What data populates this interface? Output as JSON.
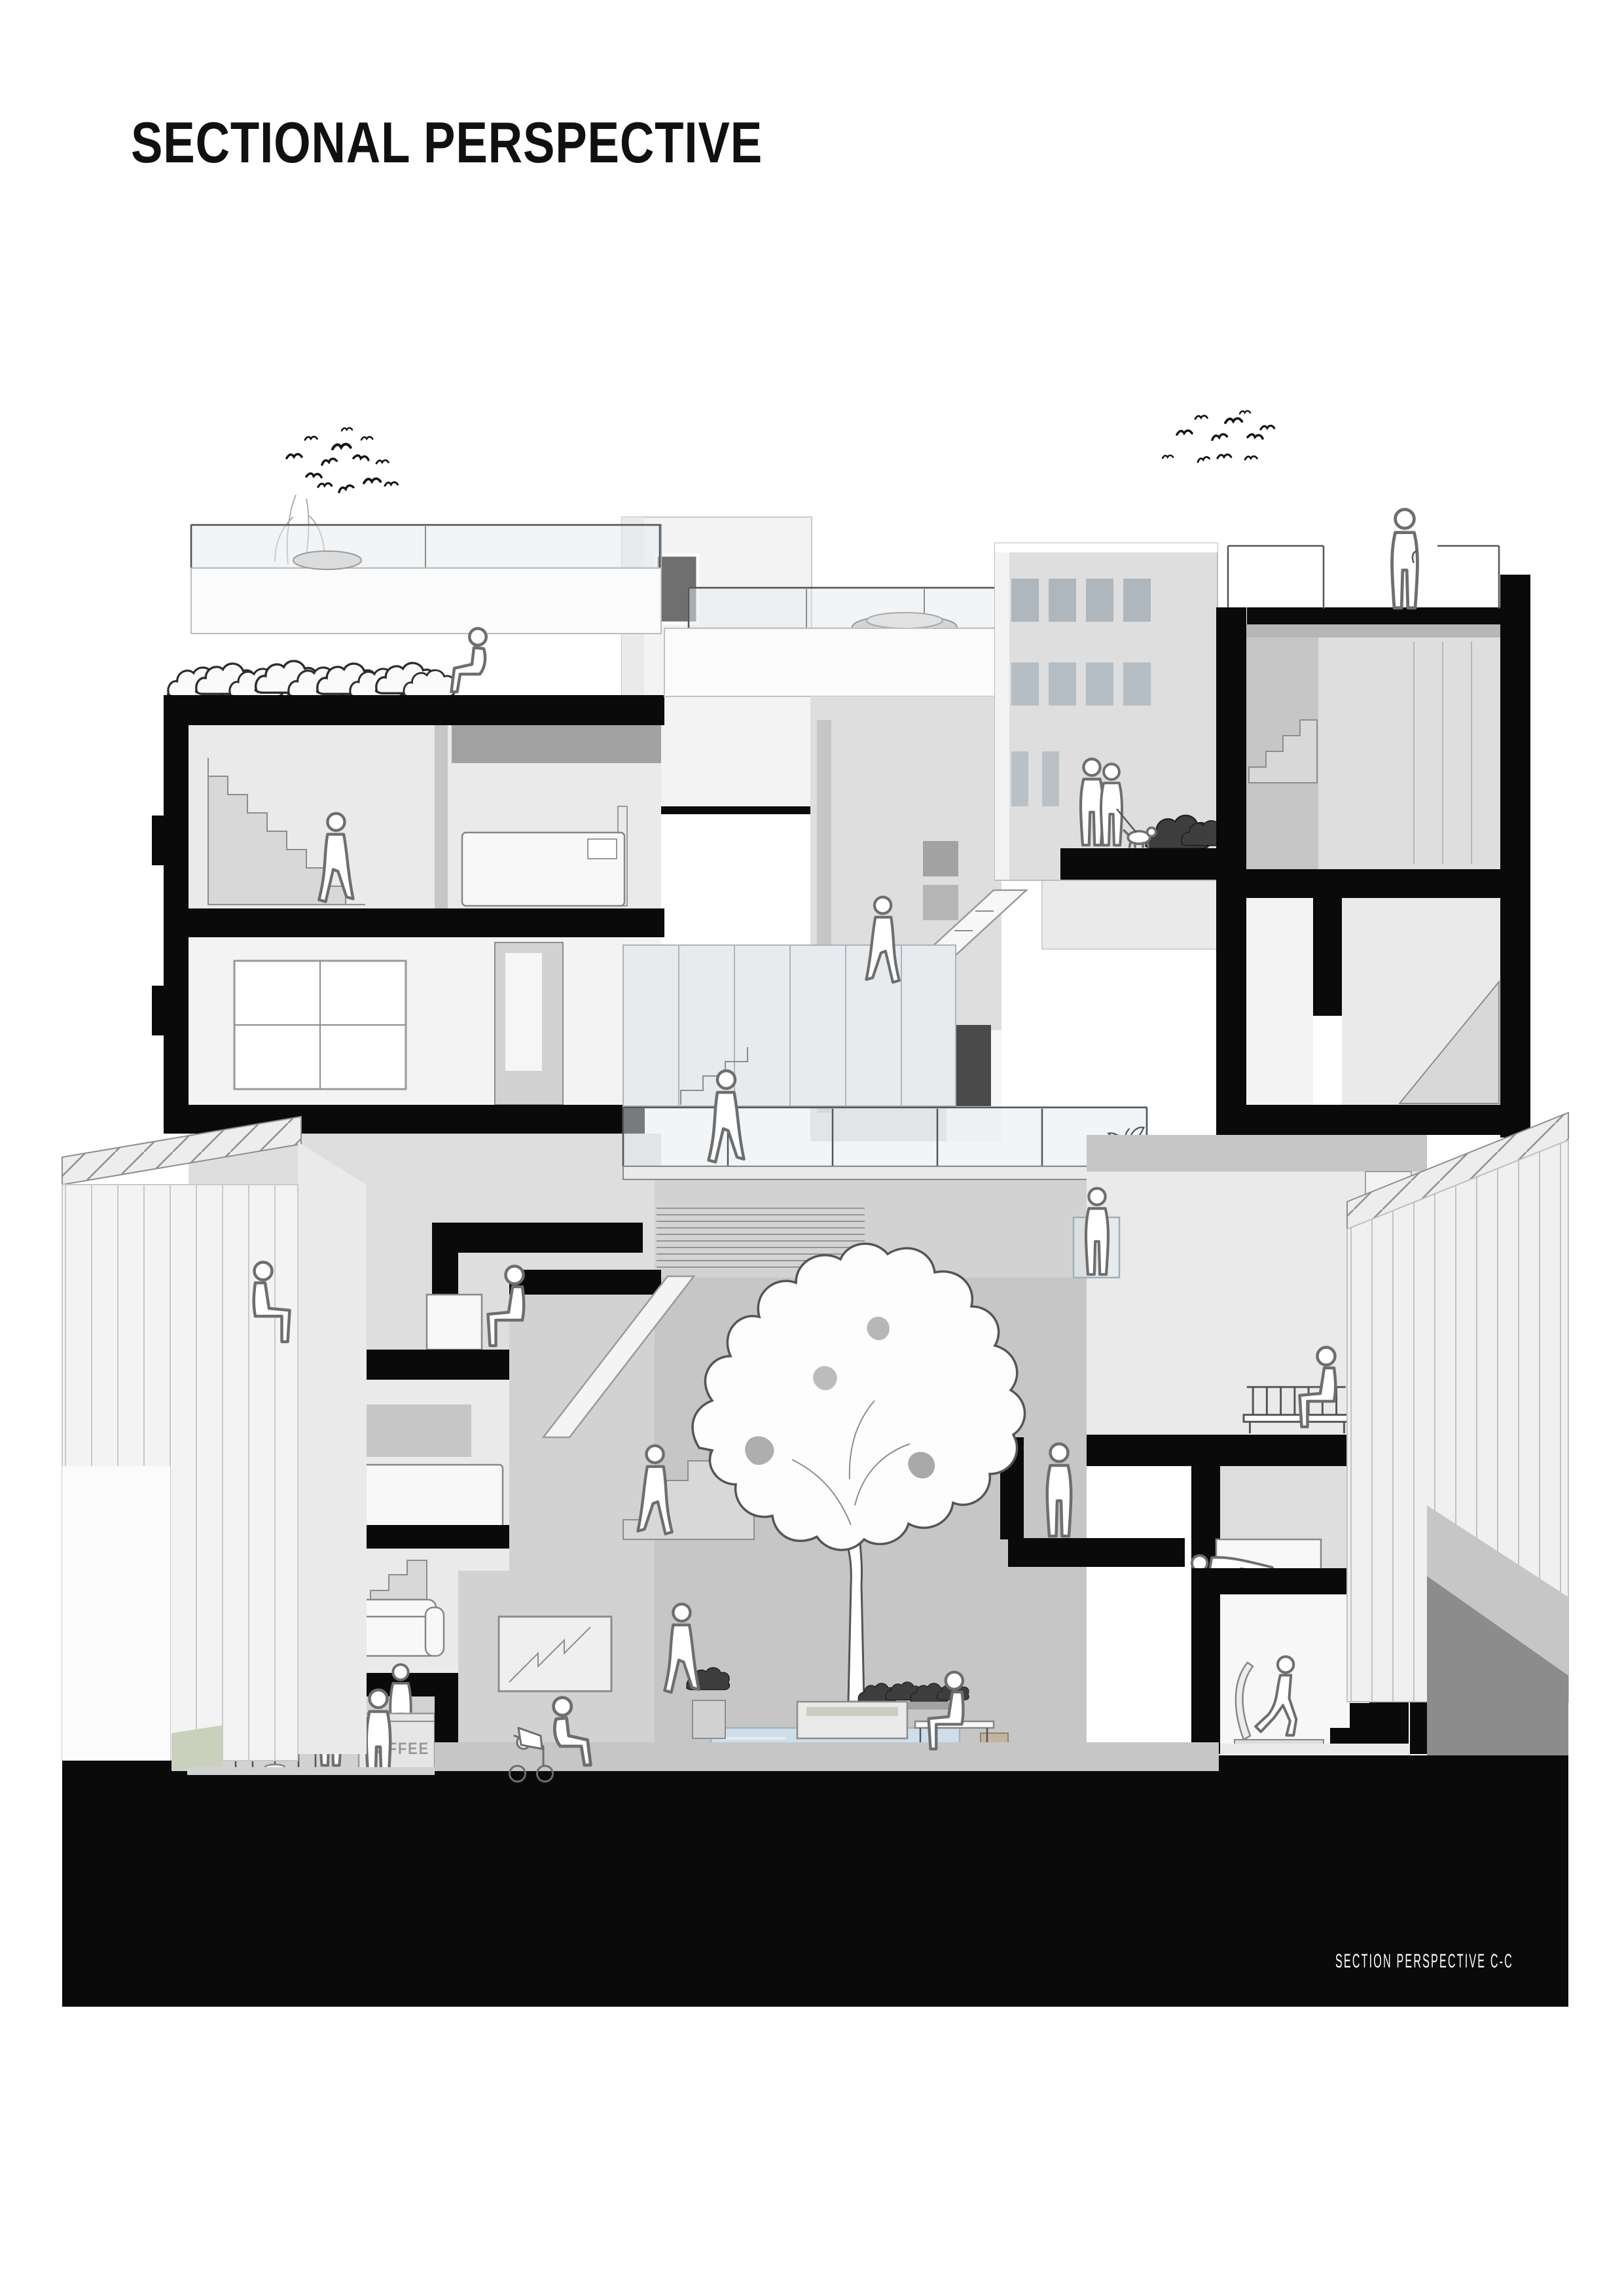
{
  "page": {
    "title": "SECTIONAL PERSPECTIVE",
    "caption": "SECTION PERSPECTIVE C-C"
  },
  "signs": {
    "coffee_counter": "COFFEE"
  },
  "colors": {
    "paper": "#ffffff",
    "ink": "#101010",
    "poche": "#0a0a0a",
    "glass": "#e3ebf0",
    "pool": "#cfdee9",
    "lawn": "#c9d1bd",
    "tan": "#c3b49e",
    "figline": "#6e6e6e",
    "captext": "#ffffff"
  },
  "scene": {
    "drawing_type": "architectural sectional perspective",
    "subject": "multi-storey residential block cut in section with black poche walls and slabs",
    "caption_position": "bottom right on black ground mass",
    "context": {
      "left_neighbour": "building with standing-seam roof and vertical cladding",
      "right_neighbour": "building with vertical cladding and hatched roof",
      "sky": "two flocks of birds"
    },
    "landscape": {
      "rooftop_hedge": "row of leafy shrubs on upper-left terrace",
      "courtyard_tree": "large white-silhouette tree in central courtyard",
      "pool": "reflecting pool at courtyard base",
      "planters": [
        "courtyard shrub planter",
        "poolside planter row",
        "balcony potted plant",
        "terrace shrub"
      ]
    },
    "figures": [
      {
        "id": "man-calling-on-roof",
        "activity": "standing on roof terrace talking on phone"
      },
      {
        "id": "couple-walking-dog",
        "activity": "couple with dog on upper terrace"
      },
      {
        "id": "man-crouching-terrace",
        "activity": "crouching at terrace edge beside hedge"
      },
      {
        "id": "woman-upper-hallway",
        "activity": "walking through upper-floor hallway"
      },
      {
        "id": "man-descending-stair",
        "activity": "walking down atrium stair"
      },
      {
        "id": "woman-on-bridge",
        "activity": "crossing glass-railed walkway"
      },
      {
        "id": "resident-on-balcony",
        "activity": "standing at mid-level balcony"
      },
      {
        "id": "elderly-woman-on-bench",
        "activity": "seated on balcony bench"
      },
      {
        "id": "woman-at-desk",
        "activity": "writing at a desk"
      },
      {
        "id": "man-reading-on-bench",
        "activity": "reading on bench beside potted plant"
      },
      {
        "id": "woman-in-robe",
        "activity": "standing on courtyard ledge"
      },
      {
        "id": "man-climbing-courtyard-stair",
        "activity": "climbing courtyard stair"
      },
      {
        "id": "woman-walking-lobby",
        "activity": "walking across ground-floor lobby"
      },
      {
        "id": "man-reading-by-pool",
        "activity": "seated on bench beside pool"
      },
      {
        "id": "mother-with-stroller",
        "activity": "crouching beside baby stroller"
      },
      {
        "id": "cafe-customer",
        "activity": "ordering at coffee counter"
      },
      {
        "id": "barista",
        "activity": "serving behind coffee counter"
      },
      {
        "id": "woman-in-cafe",
        "activity": "standing with cup beside cafe table"
      },
      {
        "id": "man-lying-on-bed",
        "activity": "lying on bed"
      },
      {
        "id": "woman-on-treadmill",
        "activity": "running on treadmill in gym"
      },
      {
        "id": "man-climbing-gym-stair",
        "activity": "walking up stair beside gym"
      }
    ],
    "rooms": [
      "roof terraces",
      "bedrooms",
      "living room with sofa",
      "desk study",
      "cafe with coffee counter",
      "ground-floor lobby",
      "courtyard with tree and pool",
      "gym with treadmill",
      "stairwells"
    ],
    "furniture": [
      "beds",
      "sofa",
      "benches",
      "desk and chair",
      "cafe table and chairs",
      "coffee counter",
      "treadmill"
    ],
    "birds": {
      "flocks": 2,
      "left_flock_count": 13,
      "right_flock_count": 11
    }
  }
}
